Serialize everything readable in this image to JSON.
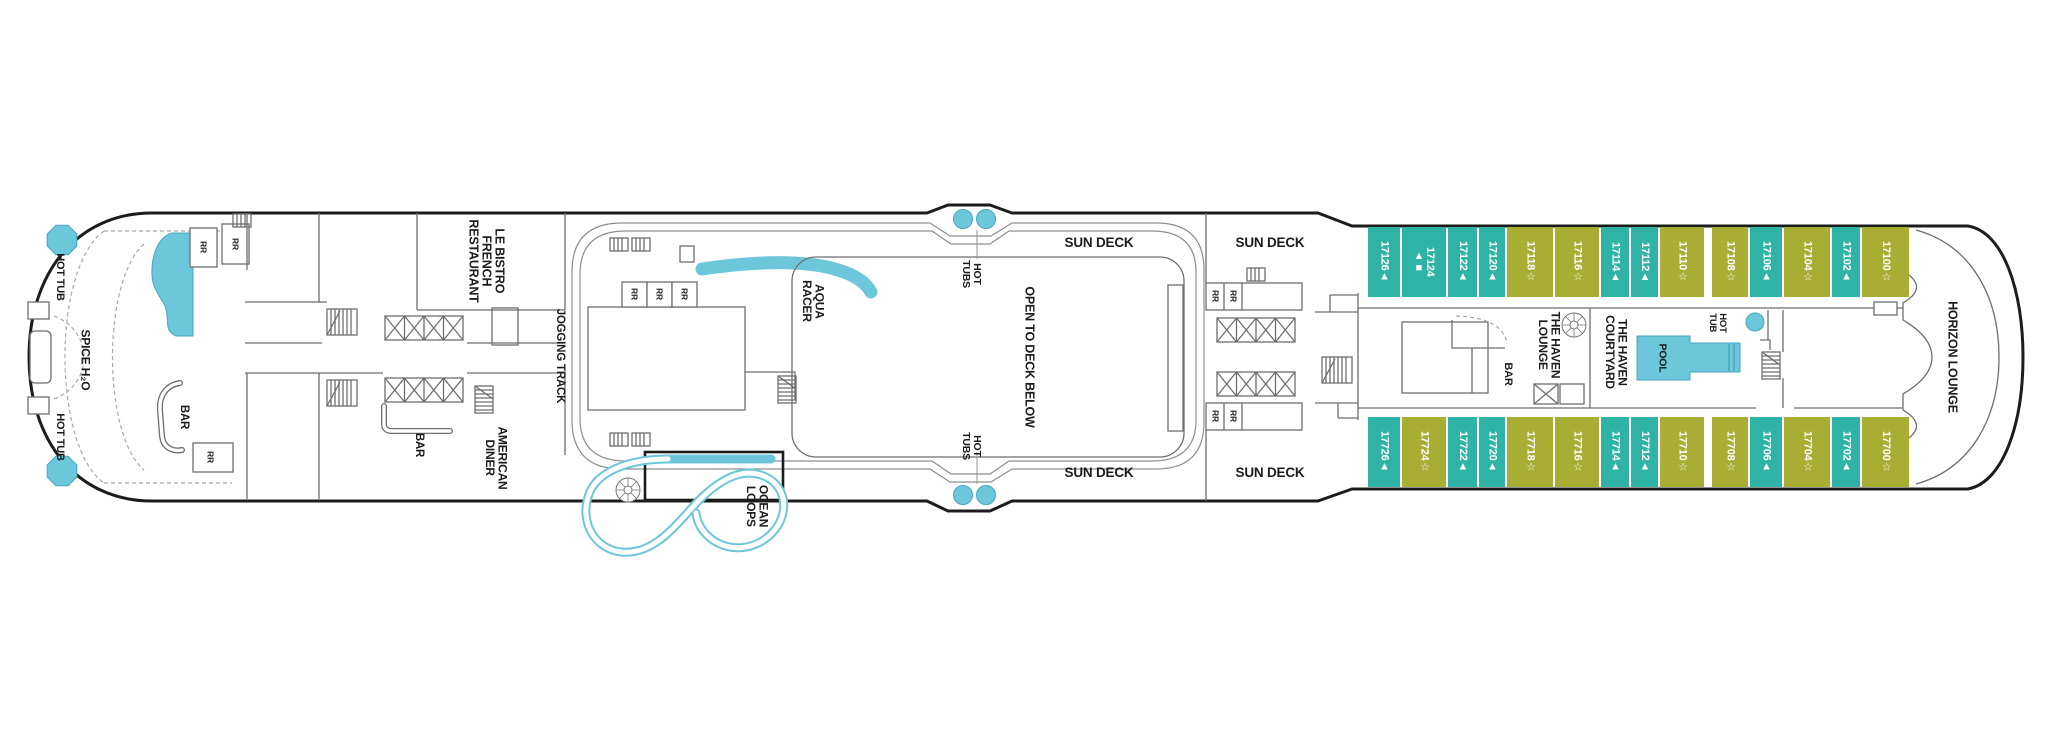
{
  "colors": {
    "cabin_teal": "#2FB3A7",
    "cabin_olive": "#A8AE33",
    "water": "#6CC7DB",
    "hull_line": "#1C1C1C"
  },
  "labels": {
    "hot_tub": "HOT TUB",
    "hot_tub_2line": "HOT\nTUB",
    "hot_tubs": "HOT\nTUBS",
    "spice_h2o": "SPICE H₂O",
    "bar": "BAR",
    "rr": "RR",
    "le_bistro": "LE BISTRO\nFRENCH\nRESTAURANT",
    "american_diner": "AMERICAN\nDINER",
    "jogging_track": "JOGGING TRACK",
    "aqua_racer": "AQUA\nRACER",
    "ocean_loops": "OCEAN\nLOOPS",
    "open_to_deck_below": "OPEN TO DECK BELOW",
    "sun_deck": "SUN DECK",
    "haven_lounge": "THE HAVEN\nLOUNGE",
    "haven_courtyard": "THE HAVEN\nCOURTYARD",
    "pool": "POOL",
    "horizon_lounge": "HORIZON LOUNGE"
  },
  "cabins": {
    "top_row": [
      {
        "number": "17126",
        "symbol": "▲",
        "category": "teal"
      },
      {
        "number": "17124",
        "symbol": "▲■",
        "category": "teal"
      },
      {
        "number": "17122",
        "symbol": "▲",
        "category": "teal"
      },
      {
        "number": "17120",
        "symbol": "▲",
        "category": "teal"
      },
      {
        "number": "17118",
        "symbol": "☆",
        "category": "olive"
      },
      {
        "number": "17116",
        "symbol": "☆",
        "category": "olive"
      },
      {
        "number": "17114",
        "symbol": "▲",
        "category": "teal"
      },
      {
        "number": "17112",
        "symbol": "▲",
        "category": "teal"
      },
      {
        "number": "17110",
        "symbol": "☆",
        "category": "olive"
      },
      {
        "number": "17108",
        "symbol": "☆",
        "category": "olive"
      },
      {
        "number": "17106",
        "symbol": "▲",
        "category": "teal"
      },
      {
        "number": "17104",
        "symbol": "☆",
        "category": "olive"
      },
      {
        "number": "17102",
        "symbol": "▲",
        "category": "teal"
      },
      {
        "number": "17100",
        "symbol": "☆",
        "category": "olive"
      }
    ],
    "bottom_row": [
      {
        "number": "17726",
        "symbol": "▲",
        "category": "teal"
      },
      {
        "number": "17724",
        "symbol": "☆",
        "category": "olive"
      },
      {
        "number": "17722",
        "symbol": "▲",
        "category": "teal"
      },
      {
        "number": "17720",
        "symbol": "▲",
        "category": "teal"
      },
      {
        "number": "17718",
        "symbol": "☆",
        "category": "olive"
      },
      {
        "number": "17716",
        "symbol": "☆",
        "category": "olive"
      },
      {
        "number": "17714",
        "symbol": "▲",
        "category": "teal"
      },
      {
        "number": "17712",
        "symbol": "▲",
        "category": "teal"
      },
      {
        "number": "17710",
        "symbol": "☆",
        "category": "olive"
      },
      {
        "number": "17708",
        "symbol": "☆",
        "category": "olive"
      },
      {
        "number": "17706",
        "symbol": "▲",
        "category": "teal"
      },
      {
        "number": "17704",
        "symbol": "☆",
        "category": "olive"
      },
      {
        "number": "17702",
        "symbol": "▲",
        "category": "teal"
      },
      {
        "number": "17700",
        "symbol": "☆",
        "category": "olive"
      }
    ]
  }
}
